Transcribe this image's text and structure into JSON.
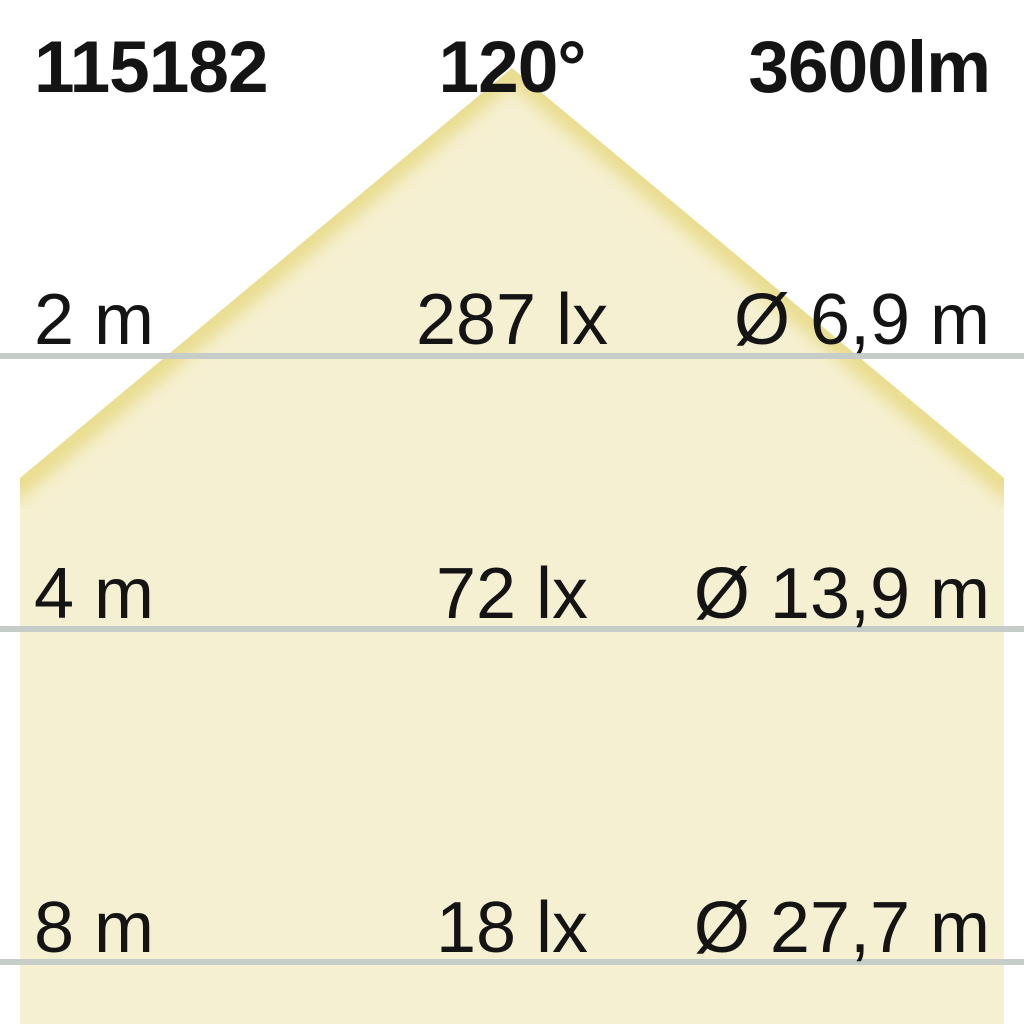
{
  "header": {
    "article_number": "115182",
    "beam_angle": "120°",
    "luminous_flux": "3600lm"
  },
  "rows": [
    {
      "distance": "2 m",
      "illuminance": "287 lx",
      "diameter": "Ø 6,9 m"
    },
    {
      "distance": "4 m",
      "illuminance": "72 lx",
      "diameter": "Ø 13,9 m"
    },
    {
      "distance": "8 m",
      "illuminance": "18 lx",
      "diameter": "Ø 27,7 m"
    }
  ],
  "colors": {
    "background": "#ffffff",
    "text": "#141414",
    "cone_fill": "#f6f0d2",
    "cone_edge": "#e9dd8e",
    "line": "#c6ccc8"
  },
  "chart_data": {
    "type": "table",
    "article_number": "115182",
    "beam_angle_deg": 120,
    "luminous_flux_lm": 3600,
    "columns": [
      "distance_m",
      "illuminance_lx",
      "beam_diameter_m"
    ],
    "rows": [
      {
        "distance_m": 2,
        "illuminance_lx": 287,
        "beam_diameter_m": 6.9
      },
      {
        "distance_m": 4,
        "illuminance_lx": 72,
        "beam_diameter_m": 13.9
      },
      {
        "distance_m": 8,
        "illuminance_lx": 18,
        "beam_diameter_m": 27.7
      }
    ]
  }
}
